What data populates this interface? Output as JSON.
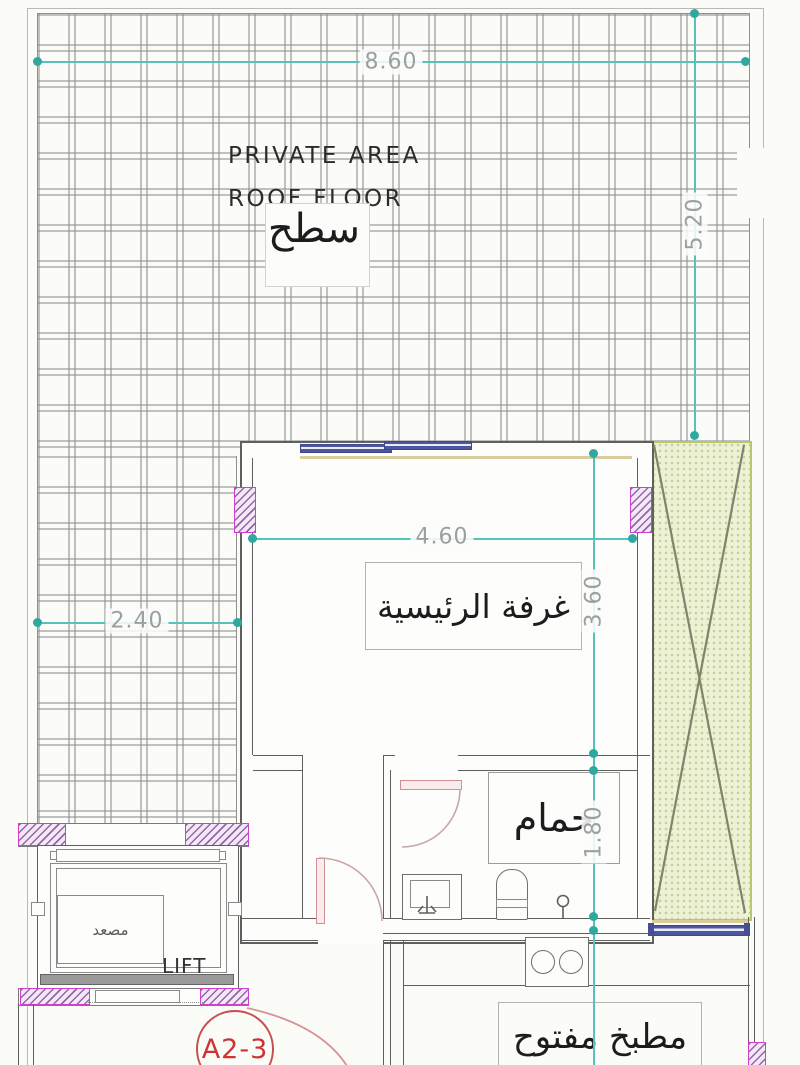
{
  "labels": {
    "private_area": "PRIVATE AREA",
    "roof_floor": "ROOF FLOOR",
    "roof_ar": "سطح",
    "master_bedroom_ar": "غرفة الرئيسية",
    "bathroom_ar": "حمام",
    "lift_ar": "مصعد",
    "lift_en": "LIFT",
    "open_kitchen_ar": "مطبخ مفتوح",
    "unit_marker": "A2-3"
  },
  "dimensions": {
    "roof_width": "8.60",
    "roof_height": "5.20",
    "roof_strip_width": "2.40",
    "bedroom_width": "4.60",
    "bedroom_height": "3.60",
    "bathroom_height": "1.80"
  },
  "colors": {
    "bg": "#fbfbf8",
    "wall": "#5f5f5f",
    "dim": "#56c3bb",
    "dimdot": "#2fa89f",
    "dimtext": "#9aa0a0",
    "colb": "#cf3fcf",
    "window": "#4d57a0",
    "shaft": "#edf2d7",
    "shaftb": "#b5c96a",
    "red": "#cc3433"
  }
}
